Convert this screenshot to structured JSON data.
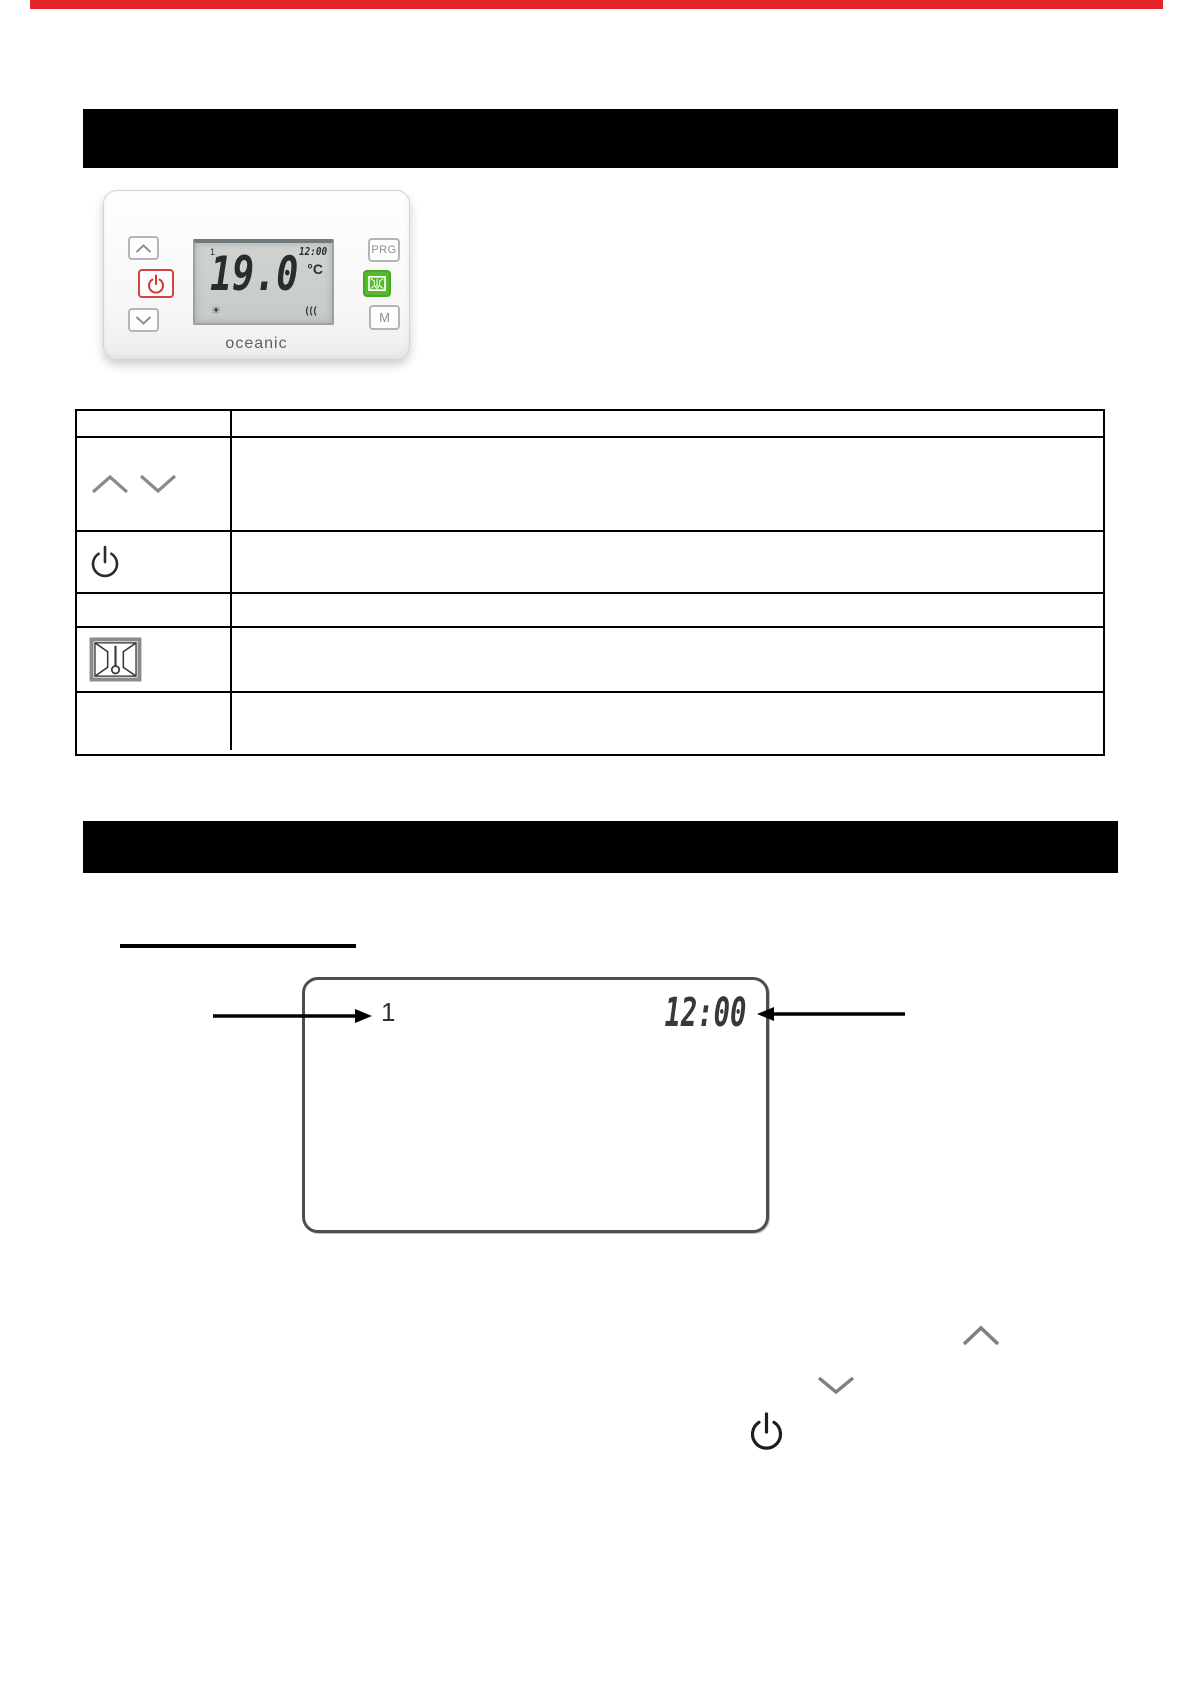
{
  "page": {
    "background": "#ffffff",
    "top_accent_color": "#e5242a"
  },
  "headers": {
    "bar1_text": "",
    "bar2_text": ""
  },
  "device": {
    "brand": "oceanic",
    "prg_label": "PRG",
    "mode_label": "M",
    "lcd": {
      "zone": "1",
      "time": "12:00",
      "temperature": "19.0",
      "unit": "°C"
    },
    "colors": {
      "power_red": "#d84340",
      "comfort_green": "#56b92c",
      "lcd_background": "#c9cdc9"
    }
  },
  "table": {
    "rows": [
      {
        "icon": "chevron-up-down",
        "description": ""
      },
      {
        "icon": "power",
        "description": ""
      },
      {
        "icon": "none",
        "description": ""
      },
      {
        "icon": "floor-heating",
        "description": ""
      },
      {
        "icon": "none",
        "description": ""
      }
    ]
  },
  "section_heading": {
    "text": ""
  },
  "diagram": {
    "zone": "1",
    "time": "12:00"
  }
}
